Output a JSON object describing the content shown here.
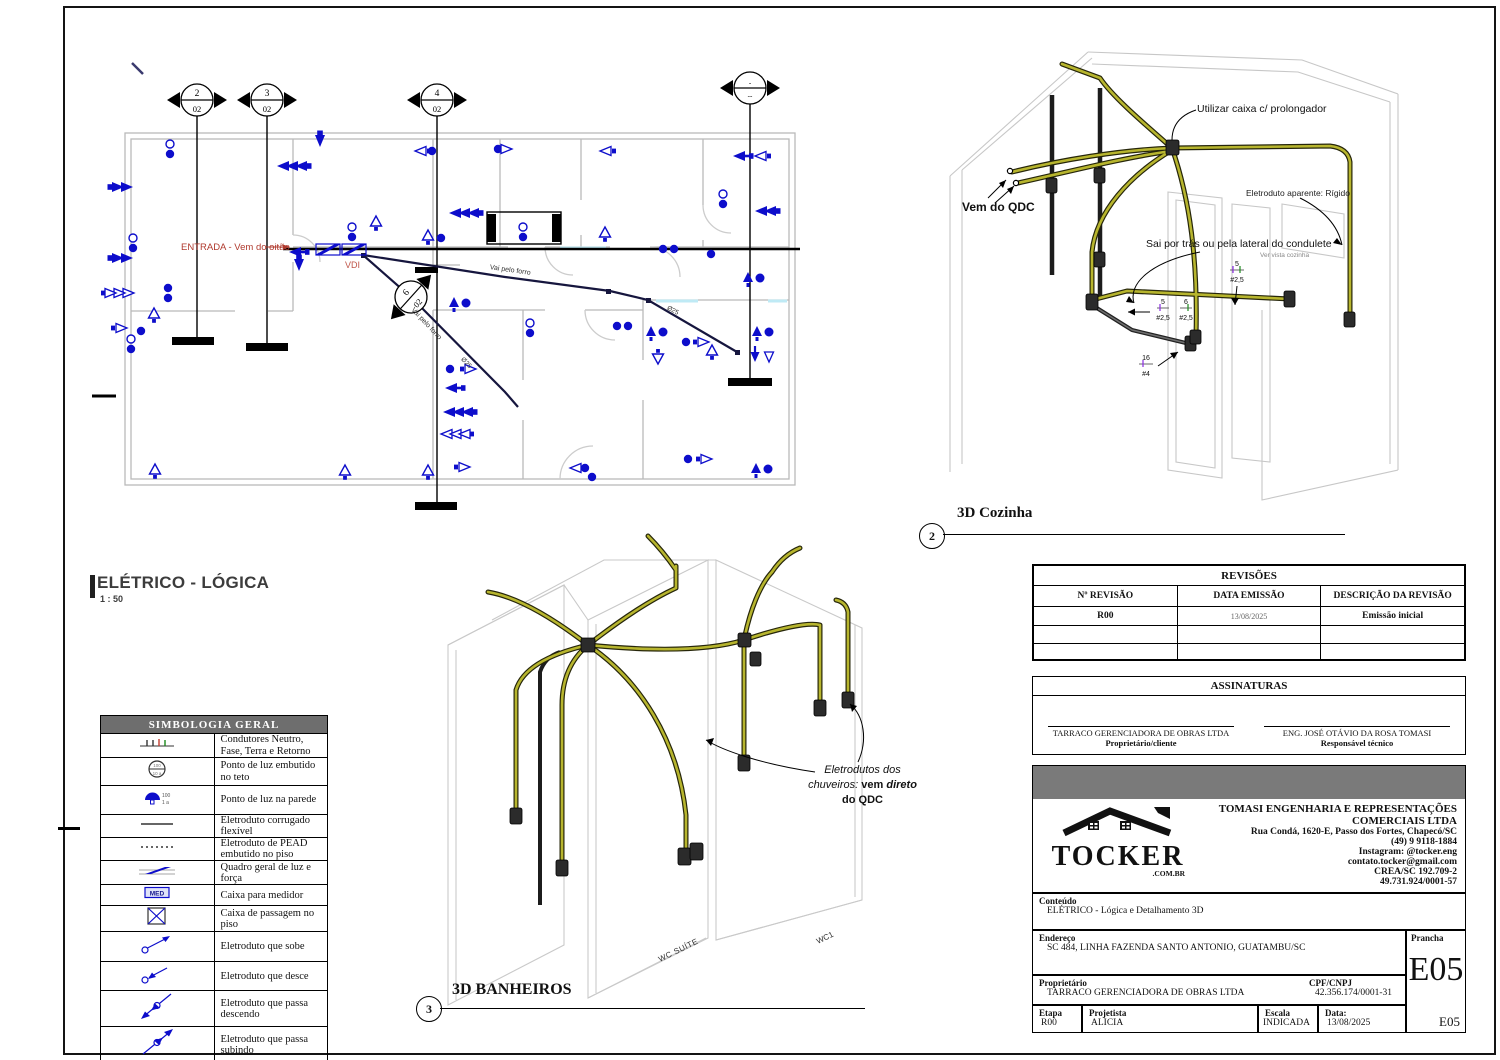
{
  "plan": {
    "title": "ELÉTRICO - LÓGICA",
    "scale": "1 : 50",
    "entrada": "ENTRADA - Vem do oitão",
    "vdi": "VDI",
    "forro1": "Vai pelo forro",
    "forro2": "Vai pelo forro",
    "dia": "Ø25",
    "markers": [
      {
        "n": "2",
        "s": "02"
      },
      {
        "n": "3",
        "s": "02"
      },
      {
        "n": "4",
        "s": "02"
      },
      {
        "n": "-",
        "s": "--"
      },
      {
        "n": "6",
        "s": "02"
      }
    ]
  },
  "cozinha": {
    "num": "2",
    "title": "3D Cozinha",
    "ann_caixa": "Utilizar caixa c/ prolongador",
    "ann_qdc": "Vem do QDC",
    "ann_aparente": "Eletroduto aparente: Rígido",
    "ann_sai": "Sai por trás ou pela lateral do condulete",
    "ann_ver": "Ver vista cozinha",
    "c1n": "5",
    "c1g": "#2,5",
    "c2n": "5",
    "c2g": "#2,5",
    "c3n": "6",
    "c3g": "#2,5",
    "c4n": "16",
    "c4g": "#4"
  },
  "banheiros": {
    "num": "3",
    "title": "3D BANHEIROS",
    "ann1": "Eletrodutos dos",
    "ann2a": "chuveiros:",
    "ann2b": "vem",
    "ann2c": "direto",
    "ann3": "do QDC",
    "wc_suite": "WC SUÍTE",
    "wc1": "WC1"
  },
  "legend": {
    "title": "SIMBOLOGIA GERAL",
    "rows": [
      {
        "icon": "conductors-icon",
        "label": "Condutores Neutro, Fase, Terra e Retorno"
      },
      {
        "icon": "ceiling-light-icon",
        "label": "Ponto de luz embutido no teto"
      },
      {
        "icon": "wall-light-icon",
        "label": "Ponto de luz na parede"
      },
      {
        "icon": "flex-conduit-icon",
        "label": "Eletroduto corrugado flexível"
      },
      {
        "icon": "pead-conduit-icon",
        "label": "Eletroduto de PEAD embutido no piso"
      },
      {
        "icon": "panel-icon",
        "label": "Quadro geral de luz e força"
      },
      {
        "icon": "meter-box-icon",
        "label": "Caixa para medidor"
      },
      {
        "icon": "floor-box-icon",
        "label": "Caixa de passagem no piso"
      },
      {
        "icon": "conduit-up-icon",
        "label": "Eletroduto que sobe"
      },
      {
        "icon": "conduit-down-icon",
        "label": "Eletroduto que desce"
      },
      {
        "icon": "conduit-pass-down-icon",
        "label": "Eletroduto que passa descendo"
      },
      {
        "icon": "conduit-pass-up-icon",
        "label": "Eletroduto que passa subindo"
      }
    ]
  },
  "revisions": {
    "title": "REVISÕES",
    "h1": "Nº REVISÃO",
    "h2": "DATA EMISSÃO",
    "h3": "DESCRIÇÃO DA REVISÃO",
    "r1c1": "R00",
    "r1c2": "13/08/2025",
    "r1c3": "Emissão inicial"
  },
  "signatures": {
    "title": "ASSINATURAS",
    "left_name": "TARRACO GERENCIADORA DE OBRAS LTDA",
    "left_role": "Proprietário/cliente",
    "right_name": "ENG. JOSÉ OTÁVIO DA ROSA TOMASI",
    "right_role": "Responsável técnico"
  },
  "company": {
    "logo": "TOCKER",
    "logo_sub": ".COM.BR",
    "name": "TOMASI ENGENHARIA E REPRESENTAÇÕES COMERCIAIS LTDA",
    "addr1": "Rua Condá, 1620-E, Passo dos Fortes, Chapecó/SC",
    "phone": "(49) 9 9118-1884",
    "insta": "Instagram: @tocker.eng",
    "email": "contato.tocker@gmail.com",
    "crea": "CREA/SC 192.709-2",
    "cnpj": "49.731.924/0001-57"
  },
  "info": {
    "conteudo_label": "Conteúdo",
    "conteudo": "ELÉTRICO - Lógica e Detalhamento 3D",
    "endereco_label": "Endereço",
    "endereco": "SC 484, LINHA FAZENDA SANTO ANTONIO, GUATAMBU/SC",
    "prop_label": "Proprietário",
    "prop": "TARRACO GERENCIADORA DE OBRAS LTDA",
    "cpf_label": "CPF/CNPJ",
    "cpf": "42.356.174/0001-31",
    "etapa_label": "Etapa",
    "etapa": "R00",
    "proj_label": "Projetista",
    "proj": "ALICIA",
    "escala_label": "Escala",
    "escala": "INDICADA",
    "data_label": "Data:",
    "data": "13/08/2025",
    "prancha_label": "Prancha",
    "prancha": "E05",
    "prancha_small": "E05"
  },
  "colors": {
    "blue": "#0d0dcb",
    "red": "#b03a2e",
    "olive": "#b7b52e"
  }
}
